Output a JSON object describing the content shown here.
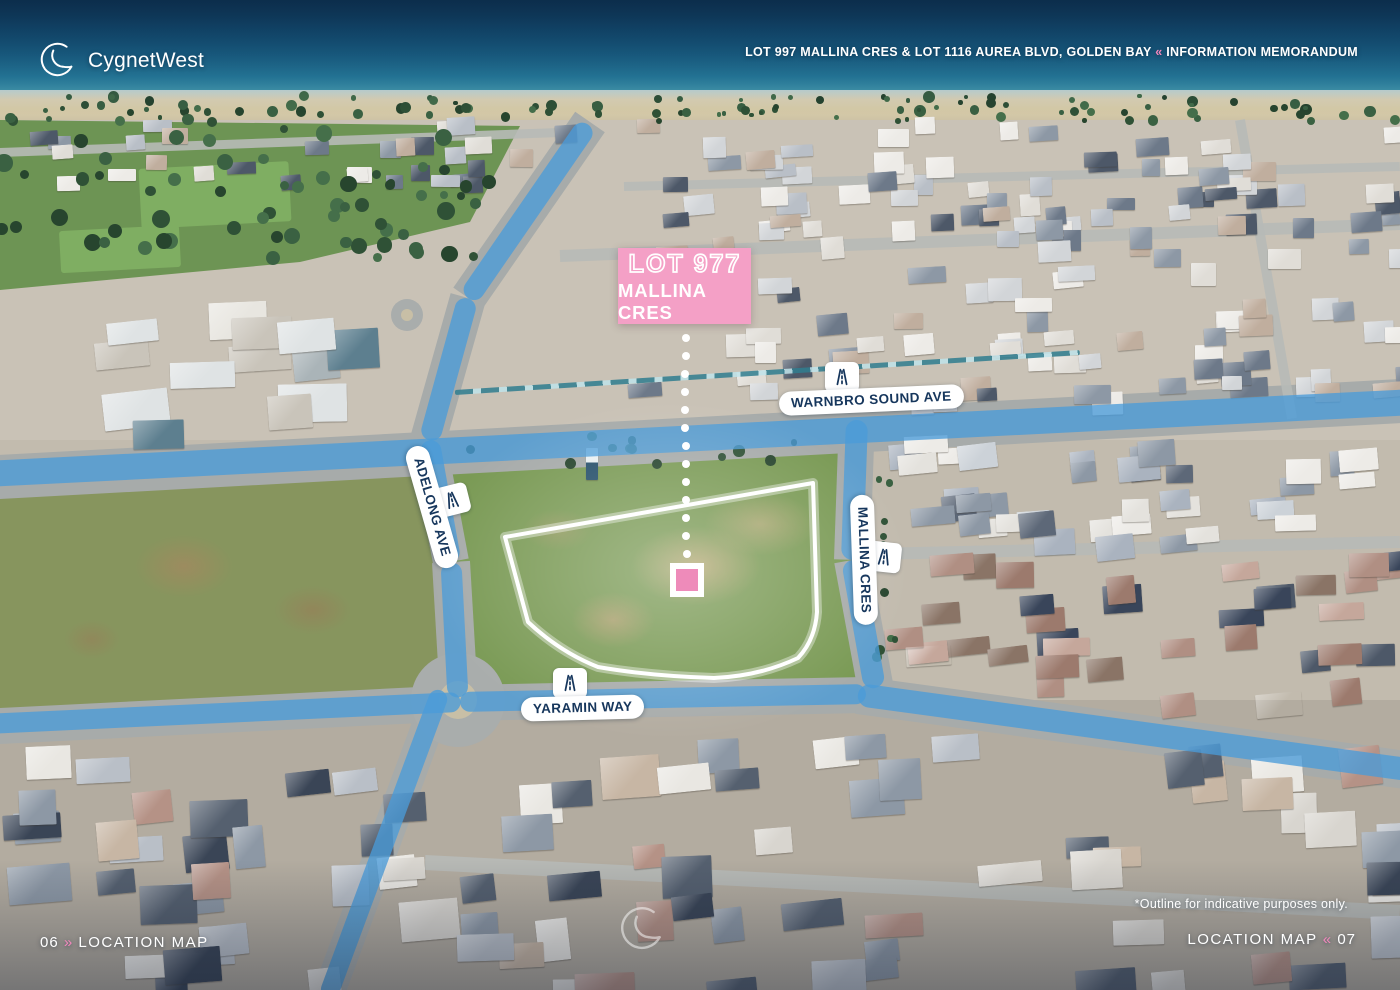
{
  "brand": {
    "name": "CygnetWest",
    "logo_icon": "cygnet-swan-logo"
  },
  "header": {
    "property": "LOT 997 MALLINA CRES & LOT 1116 AUREA BLVD, GOLDEN BAY",
    "separator": "«",
    "document_type": "INFORMATION MEMORANDUM"
  },
  "callout": {
    "lot": "LOT 977",
    "street": "MALLINA CRES"
  },
  "roads": {
    "warnbro": "WARNBRO SOUND AVE",
    "adelong": "ADELONG AVE",
    "mallina": "MALLINA CRES",
    "yaramin": "YARAMIN WAY"
  },
  "icons": {
    "road_badge": "road-icon",
    "watermark": "cygnet-swan-logo"
  },
  "marker": {
    "shape": "pink-square-on-white",
    "note": "site marker linked to callout by dotted leader"
  },
  "footer": {
    "page_left": "06",
    "sep_left": "»",
    "section_left": "LOCATION MAP",
    "disclaimer": "*Outline for indicative purposes only.",
    "section_right": "LOCATION MAP",
    "sep_right": "«",
    "page_right": "07"
  },
  "colors": {
    "accent_pink": "#F287BC",
    "callout_pink": "#F4A0C6",
    "marker_pink": "#EE8BBA",
    "road_highlight_blue": "#4A9BD8",
    "label_navy": "#16365C"
  }
}
